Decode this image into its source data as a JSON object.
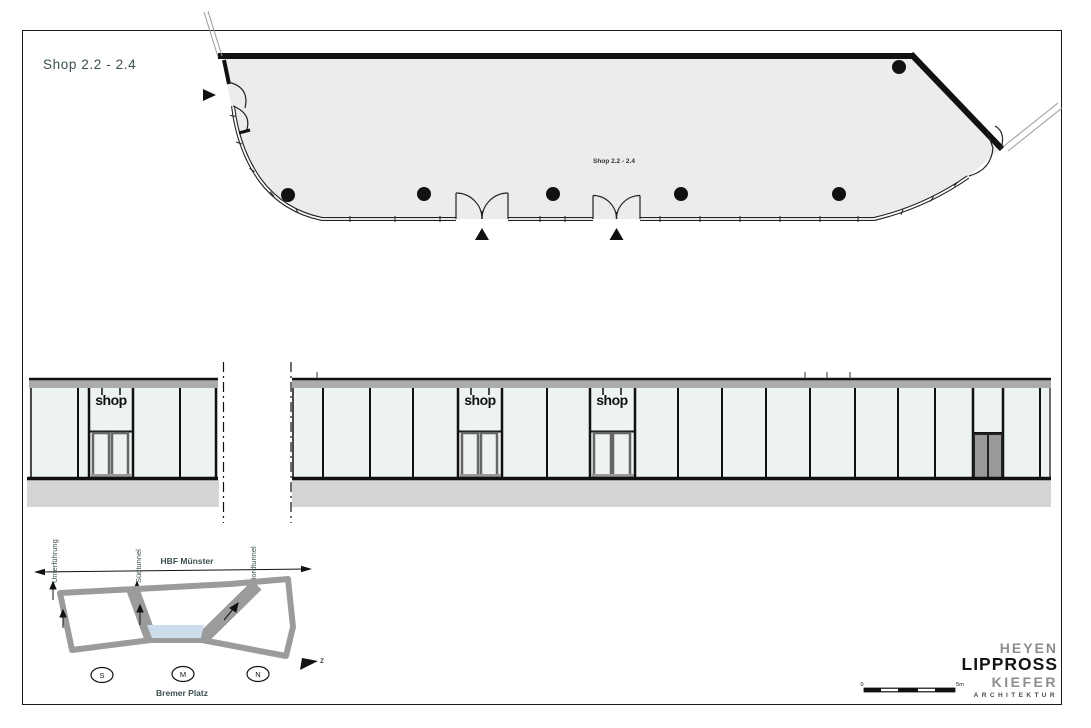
{
  "page": {
    "title": "Shop 2.2 - 2.4",
    "accent_text_color": "#3a4e50"
  },
  "floor_plan": {
    "room_label": "Shop 2.2 - 2.4",
    "fill_color": "#ececec",
    "wall_color": "#111111"
  },
  "elevation": {
    "shop_signs": [
      "shop",
      "shop",
      "shop"
    ],
    "glazing_color": "#edf3f2",
    "fascia_color": "#ababab",
    "ground_color": "#d5d5d5"
  },
  "site_diagram": {
    "station_label": "HBF Münster",
    "plaza_label": "Bremer Platz",
    "tunnel_labels": [
      "Unterführung",
      "Südtunnel",
      "Nordtunnel"
    ],
    "badges": [
      "S",
      "M",
      "N"
    ],
    "north_label": "z",
    "footprint_color": "#9b9b9b",
    "highlight_color": "#cddcea"
  },
  "scale_bar": {
    "start_label": "0",
    "end_label": "5m"
  },
  "logo": {
    "line1": "HEYEN",
    "line2": "LIPPROSS",
    "line3": "KIEFER",
    "line4": "ARCHITEKTUR"
  }
}
